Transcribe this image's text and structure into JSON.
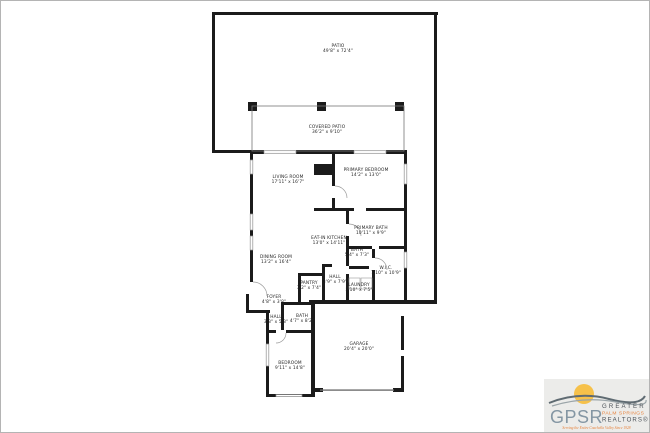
{
  "floor_plan": {
    "rooms": [
      {
        "label": "PATIO",
        "dims": "49'8\" x 72'4\"",
        "x": 338,
        "y": 47
      },
      {
        "label": "COVERED PATIO",
        "dims": "36'2\" x 9'10\"",
        "x": 327,
        "y": 128
      },
      {
        "label": "LIVING ROOM",
        "dims": "17'11\" x 16'7\"",
        "x": 288,
        "y": 178
      },
      {
        "label": "PRIMARY BEDROOM",
        "dims": "14'2\" x 13'0\"",
        "x": 366,
        "y": 171
      },
      {
        "label": "PRIMARY BATH",
        "dims": "10'11\" x 9'9\"",
        "x": 371,
        "y": 229
      },
      {
        "label": "EAT-IN KITCHEN",
        "dims": "13'0\" x 14'11\"",
        "x": 329,
        "y": 239
      },
      {
        "label": "BATH",
        "dims": "5'4\" x 7'3\"",
        "x": 357,
        "y": 251
      },
      {
        "label": "DINING ROOM",
        "dims": "13'2\" x 16'4\"",
        "x": 276,
        "y": 258
      },
      {
        "label": "W.I.C.",
        "dims": "7'10\" x 10'9\"",
        "x": 386,
        "y": 269
      },
      {
        "label": "HALL",
        "dims": "3'9\" x 7'9\"",
        "x": 335,
        "y": 278
      },
      {
        "label": "LAUNDRY",
        "dims": "5'10\" x 7'5\"",
        "x": 359,
        "y": 286
      },
      {
        "label": "PANTRY",
        "dims": "3'2\" x 7'4\"",
        "x": 309,
        "y": 284
      },
      {
        "label": "FOYER",
        "dims": "4'8\" x 3'8\"",
        "x": 274,
        "y": 298
      },
      {
        "label": "HALL",
        "dims": "3'3\" x 5'3\"",
        "x": 276,
        "y": 318
      },
      {
        "label": "BATH",
        "dims": "4'7\" x 8'2\"",
        "x": 302,
        "y": 317
      },
      {
        "label": "BEDROOM",
        "dims": "9'11\" x 14'8\"",
        "x": 290,
        "y": 364
      },
      {
        "label": "GARAGE",
        "dims": "20'4\" x 20'0\"",
        "x": 359,
        "y": 345
      }
    ]
  },
  "logo": {
    "acronym": "GPSR",
    "line1": "GREATER",
    "line2": "PALM SPRINGS",
    "line3": "REALTORS®",
    "tagline": "Serving the Entire Coachella Valley Since 1928",
    "colors": {
      "orange": "#e8823b",
      "slate": "#8496a3",
      "dark_gray": "#4c5258",
      "sun_yellow": "#f6c14a",
      "wall_black": "#1b1b1b"
    }
  }
}
